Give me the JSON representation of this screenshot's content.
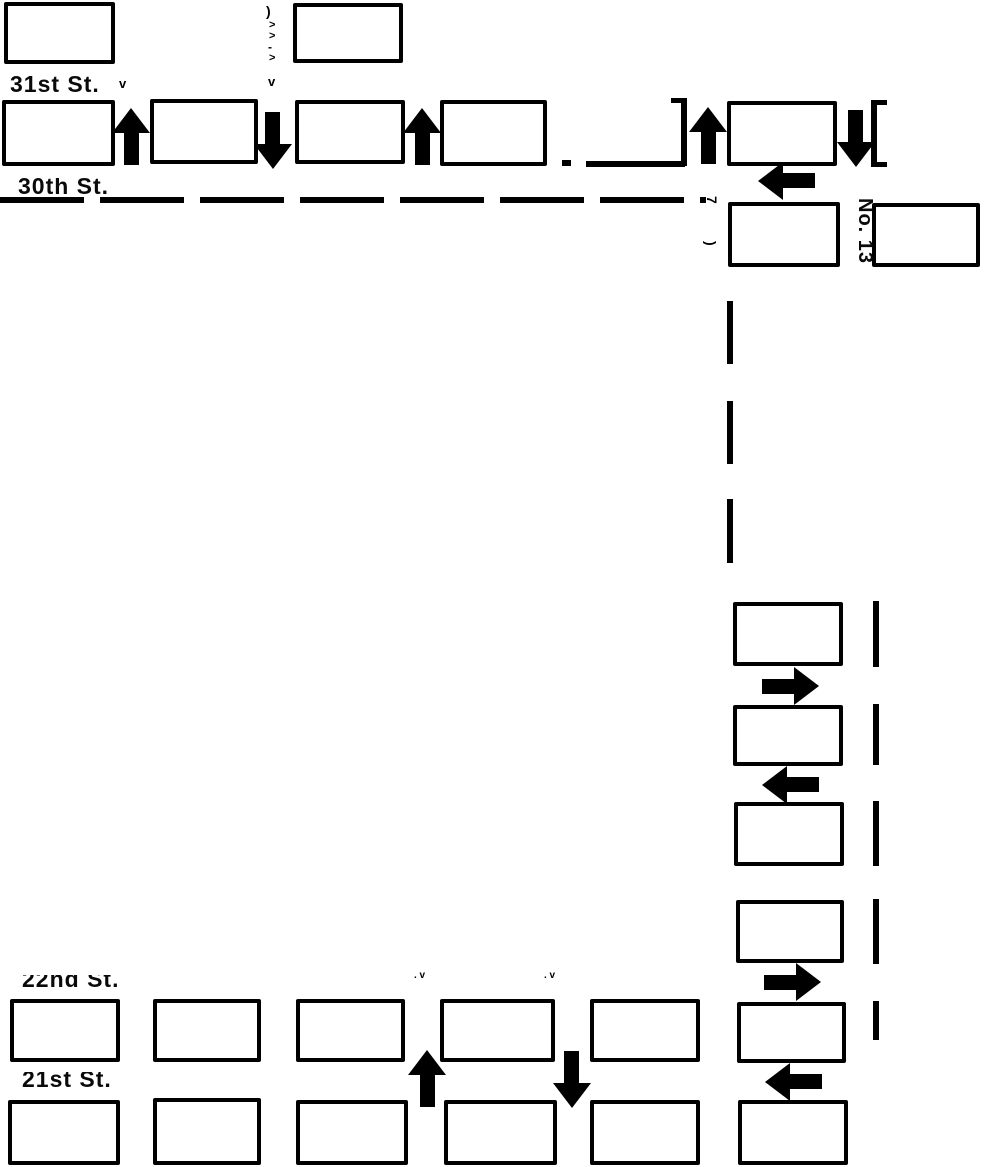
{
  "canvas": {
    "width": 985,
    "height": 1167
  },
  "colors": {
    "ink": "#000000",
    "paper": "#ffffff"
  },
  "street_labels": [
    {
      "name": "street-label-31st",
      "text": "31st St.",
      "x": 10,
      "y": 71,
      "font_size": 23,
      "clip_top": 5
    },
    {
      "name": "street-label-30th",
      "text": "30th St.",
      "x": 18,
      "y": 173,
      "font_size": 23,
      "clip_top": 5
    },
    {
      "name": "street-label-22nd",
      "text": "22nd St.",
      "x": 22,
      "y": 966,
      "font_size": 23,
      "clip_top": 9
    },
    {
      "name": "street-label-21st",
      "text": "21st St.",
      "x": 22,
      "y": 1066,
      "font_size": 23,
      "clip_top": 6
    }
  ],
  "vertical_labels": [
    {
      "name": "lot-number-13",
      "text": "No. 13",
      "x": 876,
      "y": 198,
      "font_size": 20,
      "rotate": 90
    }
  ],
  "fragments": [
    {
      "text": ")",
      "x": 266,
      "y": 4,
      "size": 14,
      "rotate": 0
    },
    {
      "text": ">",
      "x": 269,
      "y": 20,
      "size": 11,
      "rotate": 0
    },
    {
      "text": ">",
      "x": 269,
      "y": 31,
      "size": 11,
      "rotate": 0
    },
    {
      "text": "-",
      "x": 268,
      "y": 41,
      "size": 12,
      "rotate": 0
    },
    {
      "text": ">",
      "x": 269,
      "y": 53,
      "size": 11,
      "rotate": 0
    },
    {
      "text": "v",
      "x": 119,
      "y": 77,
      "size": 13,
      "rotate": 0
    },
    {
      "text": "v",
      "x": 268,
      "y": 75,
      "size": 13,
      "rotate": 0
    },
    {
      "text": "7",
      "x": 719,
      "y": 196,
      "size": 14,
      "rotate": 90
    },
    {
      "text": ")",
      "x": 718,
      "y": 241,
      "size": 14,
      "rotate": 90
    },
    {
      "text": ". v",
      "x": 414,
      "y": 971,
      "size": 10,
      "rotate": 0
    },
    {
      "text": ". v",
      "x": 544,
      "y": 971,
      "size": 10,
      "rotate": 0
    }
  ],
  "blocks": [
    {
      "x": 4,
      "y": 2,
      "w": 111,
      "h": 62
    },
    {
      "x": 293,
      "y": 3,
      "w": 110,
      "h": 60
    },
    {
      "x": 2,
      "y": 100,
      "w": 113,
      "h": 66
    },
    {
      "x": 150,
      "y": 99,
      "w": 108,
      "h": 65
    },
    {
      "x": 295,
      "y": 100,
      "w": 110,
      "h": 64
    },
    {
      "x": 440,
      "y": 100,
      "w": 107,
      "h": 66
    },
    {
      "x": 727,
      "y": 101,
      "w": 110,
      "h": 65
    },
    {
      "x": 728,
      "y": 202,
      "w": 112,
      "h": 65
    },
    {
      "x": 872,
      "y": 203,
      "w": 108,
      "h": 64
    },
    {
      "x": 733,
      "y": 602,
      "w": 110,
      "h": 64
    },
    {
      "x": 733,
      "y": 705,
      "w": 110,
      "h": 61
    },
    {
      "x": 734,
      "y": 802,
      "w": 110,
      "h": 64
    },
    {
      "x": 736,
      "y": 900,
      "w": 108,
      "h": 63
    },
    {
      "x": 737,
      "y": 1002,
      "w": 109,
      "h": 61
    },
    {
      "x": 738,
      "y": 1100,
      "w": 110,
      "h": 65
    },
    {
      "x": 10,
      "y": 999,
      "w": 110,
      "h": 63
    },
    {
      "x": 153,
      "y": 999,
      "w": 108,
      "h": 63
    },
    {
      "x": 296,
      "y": 999,
      "w": 109,
      "h": 63
    },
    {
      "x": 440,
      "y": 999,
      "w": 115,
      "h": 63
    },
    {
      "x": 590,
      "y": 999,
      "w": 110,
      "h": 63
    },
    {
      "x": 8,
      "y": 1100,
      "w": 112,
      "h": 65
    },
    {
      "x": 153,
      "y": 1098,
      "w": 108,
      "h": 67
    },
    {
      "x": 296,
      "y": 1100,
      "w": 112,
      "h": 65
    },
    {
      "x": 444,
      "y": 1100,
      "w": 113,
      "h": 65
    },
    {
      "x": 590,
      "y": 1100,
      "w": 110,
      "h": 65
    }
  ],
  "arrows": [
    {
      "dir": "up",
      "cx": 131,
      "cy": 137
    },
    {
      "dir": "down",
      "cx": 273,
      "cy": 140
    },
    {
      "dir": "up",
      "cx": 422,
      "cy": 137
    },
    {
      "dir": "up",
      "cx": 708,
      "cy": 136
    },
    {
      "dir": "down",
      "cx": 856,
      "cy": 138
    },
    {
      "dir": "left",
      "cx": 787,
      "cy": 181
    },
    {
      "dir": "right",
      "cx": 790,
      "cy": 686
    },
    {
      "dir": "left",
      "cx": 791,
      "cy": 785
    },
    {
      "dir": "right",
      "cx": 792,
      "cy": 982
    },
    {
      "dir": "left",
      "cx": 794,
      "cy": 1082
    },
    {
      "dir": "up",
      "cx": 427,
      "cy": 1079
    },
    {
      "dir": "down",
      "cx": 572,
      "cy": 1079
    }
  ],
  "bars": [
    {
      "x": 562,
      "y": 160,
      "w": 9,
      "h": 6
    },
    {
      "x": 586,
      "y": 161,
      "w": 99,
      "h": 6
    },
    {
      "x": 681,
      "y": 99,
      "w": 6,
      "h": 67
    },
    {
      "x": 671,
      "y": 98,
      "w": 16,
      "h": 5
    },
    {
      "x": 871,
      "y": 101,
      "w": 6,
      "h": 66
    },
    {
      "x": 871,
      "y": 100,
      "w": 16,
      "h": 5
    },
    {
      "x": 871,
      "y": 162,
      "w": 16,
      "h": 5
    },
    {
      "x": 727,
      "y": 301,
      "w": 6,
      "h": 63
    },
    {
      "x": 727,
      "y": 401,
      "w": 6,
      "h": 63
    },
    {
      "x": 727,
      "y": 499,
      "w": 6,
      "h": 64
    },
    {
      "x": 873,
      "y": 601,
      "w": 6,
      "h": 66
    },
    {
      "x": 873,
      "y": 704,
      "w": 6,
      "h": 61
    },
    {
      "x": 873,
      "y": 801,
      "w": 6,
      "h": 65
    },
    {
      "x": 873,
      "y": 899,
      "w": 6,
      "h": 65
    },
    {
      "x": 873,
      "y": 1001,
      "w": 6,
      "h": 39
    }
  ],
  "dashed_lines": [
    {
      "orient": "h",
      "x": 0,
      "y": 197,
      "length": 706,
      "thickness": 6,
      "dash": 84,
      "gap": 16
    }
  ]
}
